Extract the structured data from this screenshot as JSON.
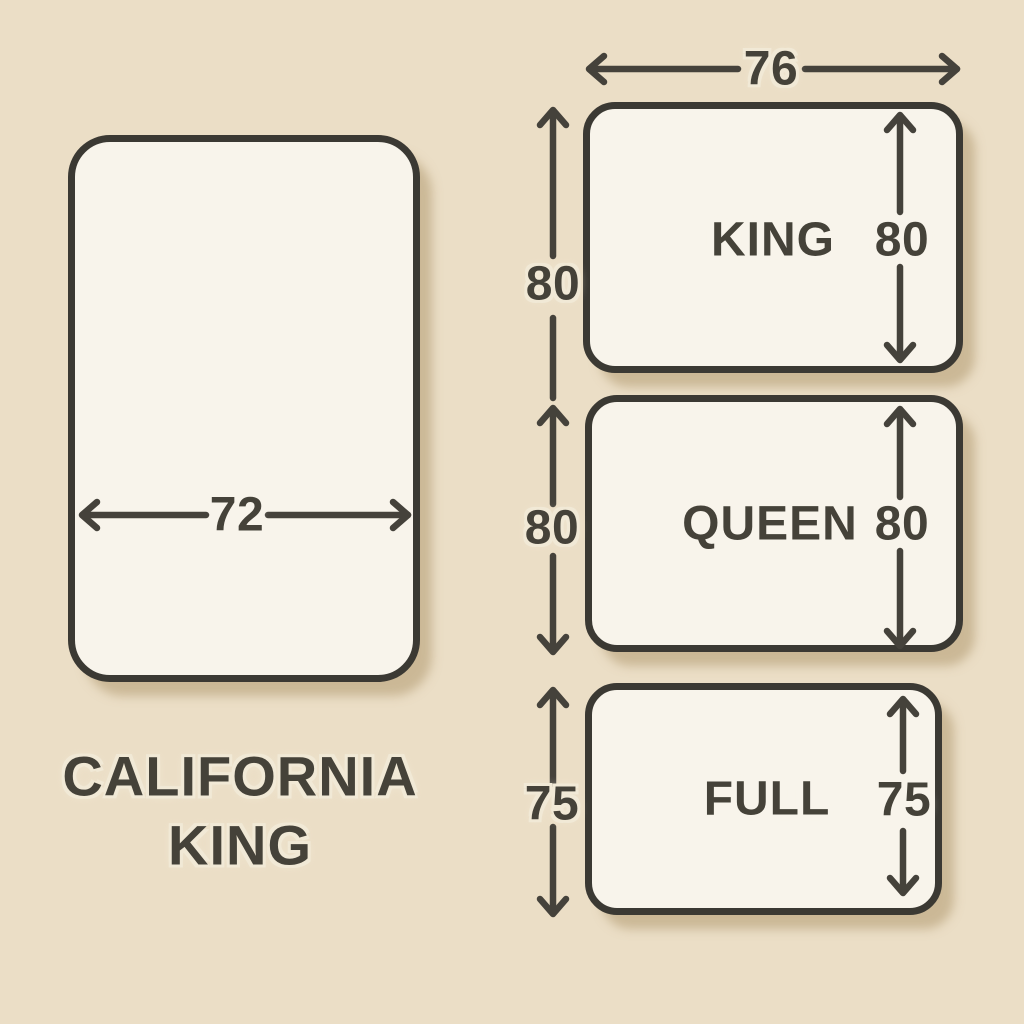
{
  "diagram_title": "Mattress size comparison",
  "colors": {
    "background": "#ebdec6",
    "mattress_fill": "#f8f4eb",
    "outline": "#3b3933",
    "text": "#454239",
    "shadow": "#d9caa8"
  },
  "california_king": {
    "name_line1": "CALIFORNIA",
    "name_line2": "KING",
    "width_in": "72"
  },
  "king": {
    "name": "KING",
    "width_in": "76",
    "height_in": "80"
  },
  "queen": {
    "name": "QUEEN",
    "height_in": "80"
  },
  "full": {
    "name": "FULL",
    "height_in": "75"
  }
}
